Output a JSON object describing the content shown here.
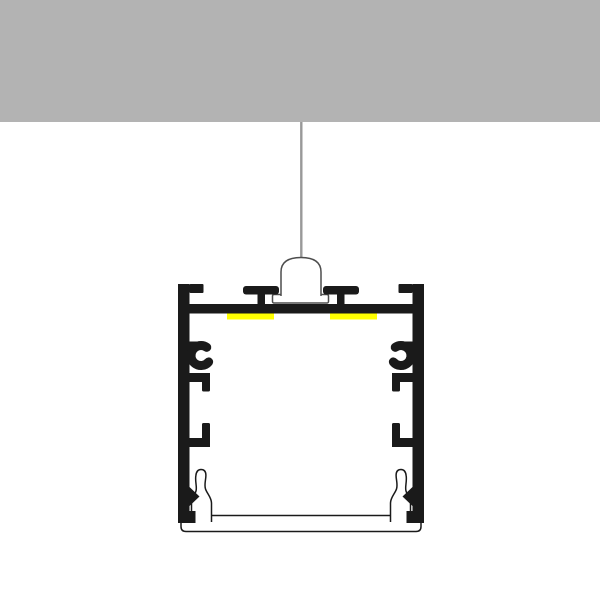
{
  "diagram": {
    "kind": "led-aluminum-profile-suspended-mounting-cross-section",
    "scene": {
      "ceiling": "solid gray slab across full width at top",
      "suspension": "thin cable from ceiling to a bell-shaped suspension mount",
      "profile": "black square LED aluminum extrusion cross-section",
      "led_strips": "two yellow LED strips under the top wall",
      "diffuser": "white clip-in diffuser lens with two spring legs at bottom"
    },
    "parts": [
      {
        "name": "ceiling-slab"
      },
      {
        "name": "suspension-cable"
      },
      {
        "name": "suspension-mount-bell"
      },
      {
        "name": "suspension-mount-flange"
      },
      {
        "name": "profile-top-wall"
      },
      {
        "name": "profile-corner-flange-left"
      },
      {
        "name": "profile-corner-flange-right"
      },
      {
        "name": "t-slot-post-left"
      },
      {
        "name": "t-slot-post-right"
      },
      {
        "name": "led-strip-left"
      },
      {
        "name": "led-strip-right"
      },
      {
        "name": "profile-side-wall-left"
      },
      {
        "name": "profile-side-wall-right"
      },
      {
        "name": "c-clip-left"
      },
      {
        "name": "c-clip-right"
      },
      {
        "name": "retainer-hook-upper-left"
      },
      {
        "name": "retainer-hook-upper-right"
      },
      {
        "name": "retainer-hook-lower-left"
      },
      {
        "name": "retainer-hook-lower-right"
      },
      {
        "name": "snap-tooth-left"
      },
      {
        "name": "snap-tooth-right"
      },
      {
        "name": "corner-block-left"
      },
      {
        "name": "corner-block-right"
      },
      {
        "name": "diffuser-shelf"
      },
      {
        "name": "diffuser-plate"
      },
      {
        "name": "diffuser-leg-left"
      },
      {
        "name": "diffuser-leg-right"
      }
    ]
  },
  "colors": {
    "background": "#ffffff",
    "ceiling_gray": "#b3b3b3",
    "cable_gray": "#999999",
    "profile_black": "#1a1a1a",
    "led_yellow": "#ffff00",
    "fixture_white": "#ffffff",
    "mount_outline": "#4d4d4d",
    "diffuser_outline": "#1a1a1a"
  }
}
